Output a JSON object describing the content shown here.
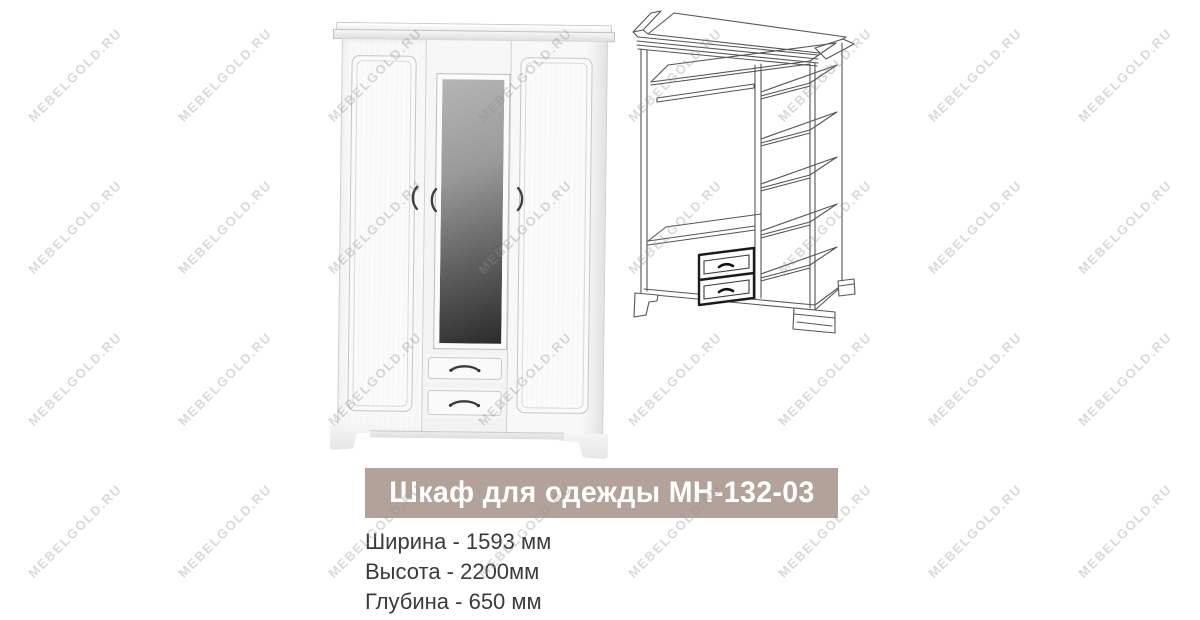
{
  "product": {
    "title": "Шкаф для одежды МН-132-03",
    "specs": [
      "Ширина - 1593 мм",
      "Высота - 2200мм",
      "Глубина - 650 мм"
    ]
  },
  "watermark": {
    "text": "MEBELGOLD.RU",
    "grid": {
      "start_x": 75,
      "start_y": 75,
      "step_x": 150,
      "step_y": 152,
      "cols": 8,
      "rows": 4
    }
  },
  "colors": {
    "title_bar_bg": "#b3a29a",
    "title_text": "#ffffff",
    "spec_text": "#3a3a3a",
    "watermark_text": "#dedcda",
    "diagram_line": "#555555",
    "mirror_dark": "#2b2b2b",
    "handle": "#3f3f3f"
  }
}
